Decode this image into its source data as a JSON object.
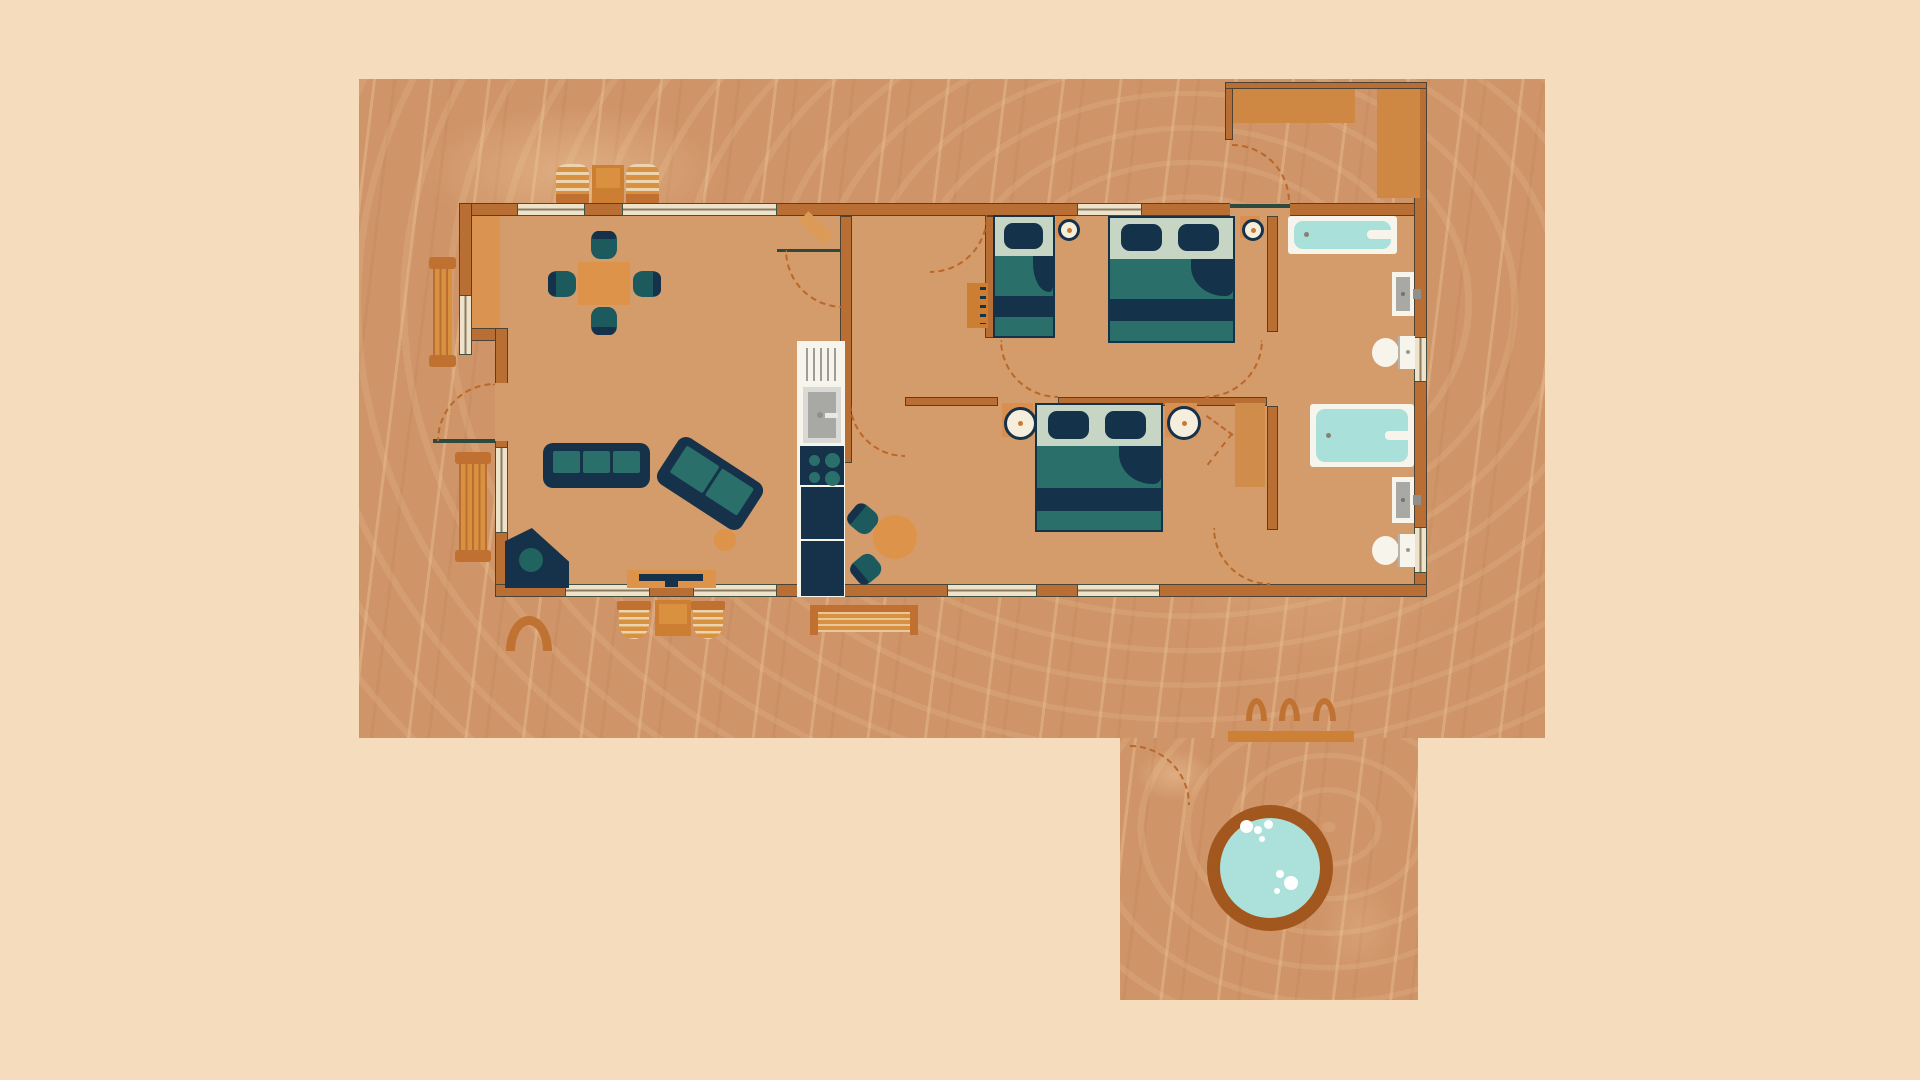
{
  "title": "Cabin floor plan illustration",
  "palette": {
    "background": "#f4dcbd",
    "deck": "#cf9468",
    "floor": "#d49c6b",
    "wall": "#b96f33",
    "wall_outline": "#4d4233",
    "accent_orange": "#dd9349",
    "accent_dark": "#c07030",
    "canopy": "#cf8843",
    "navy": "#16324a",
    "teal": "#1d5a5e",
    "teal_mid": "#2a6f6a",
    "sage": "#c7d5c5",
    "window_fill": "#efe2cb",
    "fixture_white": "#f7f4ec",
    "basin_gray": "#a8a8a4",
    "water": "#a9e0da",
    "hottub_rim": "#a2571e",
    "door_swing_dash": "#b9682a",
    "door_line": "#2e4a3e",
    "rug": "#da9350",
    "wardrobe": "#d08c4a"
  },
  "floorplan": {
    "canvas": {
      "width": 1920,
      "height": 1080
    },
    "elements": [
      {
        "type": "deck",
        "name": "deck-main",
        "x": 359,
        "y": 79,
        "w": 1186,
        "h": 659
      },
      {
        "type": "deck",
        "name": "deck-lower-hot-tub-area",
        "x": 1120,
        "y": 738,
        "w": 298,
        "h": 262
      },
      {
        "type": "lounger",
        "name": "deck-lounger-1",
        "x": 556,
        "y": 164,
        "w": 33,
        "h": 40
      },
      {
        "type": "rect",
        "name": "deck-lounger-table",
        "x": 592,
        "y": 165,
        "w": 32,
        "h": 39,
        "fill": "#cc7f33"
      },
      {
        "type": "rect",
        "name": "deck-lounger-table-top",
        "x": 596,
        "y": 168,
        "w": 24,
        "h": 20,
        "fill": "#d9903f"
      },
      {
        "type": "lounger",
        "name": "deck-lounger-2",
        "x": 626,
        "y": 164,
        "w": 33,
        "h": 40
      },
      {
        "type": "benchv",
        "name": "deck-bench-upper-left",
        "x": 429,
        "y": 257,
        "w": 27,
        "h": 110
      },
      {
        "type": "benchv",
        "name": "deck-bench-lower-left",
        "x": 455,
        "y": 452,
        "w": 36,
        "h": 110
      },
      {
        "type": "outchair",
        "name": "deck-chair-1",
        "x": 617,
        "y": 601,
        "w": 34,
        "h": 38
      },
      {
        "type": "rect",
        "name": "deck-table",
        "x": 655,
        "y": 600,
        "w": 36,
        "h": 36,
        "fill": "#cc7f33"
      },
      {
        "type": "rect",
        "name": "deck-table-top",
        "x": 659,
        "y": 604,
        "w": 28,
        "h": 20,
        "fill": "#d9903f"
      },
      {
        "type": "outchair",
        "name": "deck-chair-2",
        "x": 691,
        "y": 601,
        "w": 34,
        "h": 38
      },
      {
        "type": "benchlong",
        "name": "deck-bench-long",
        "x": 810,
        "y": 605,
        "w": 108,
        "h": 30
      },
      {
        "type": "arch",
        "name": "deck-arch-mat",
        "x": 506,
        "y": 616,
        "w": 46,
        "h": 35,
        "bw": 9
      },
      {
        "type": "arch",
        "name": "hot-tub-step-hoop-1",
        "x": 1246,
        "y": 698,
        "w": 21,
        "h": 23,
        "bw": 6
      },
      {
        "type": "arch",
        "name": "hot-tub-step-hoop-2",
        "x": 1279,
        "y": 698,
        "w": 21,
        "h": 23,
        "bw": 6
      },
      {
        "type": "arch",
        "name": "hot-tub-step-hoop-3",
        "x": 1313,
        "y": 698,
        "w": 23,
        "h": 23,
        "bw": 6
      },
      {
        "type": "rect",
        "name": "hot-tub-step-bar",
        "x": 1228,
        "y": 731,
        "w": 126,
        "h": 11,
        "fill": "#cc8136"
      },
      {
        "type": "arc",
        "name": "hot-tub-path-arc",
        "x": 1130,
        "y": 745,
        "w": 60,
        "h": 60,
        "corner": "tr"
      },
      {
        "type": "hottub",
        "name": "hot-tub",
        "x": 1207,
        "y": 805,
        "w": 126,
        "h": 126,
        "bubbles": [
          [
            33,
            15,
            13
          ],
          [
            47,
            21,
            8
          ],
          [
            57,
            15,
            9
          ],
          [
            52,
            31,
            6
          ],
          [
            77,
            71,
            14
          ],
          [
            69,
            65,
            8
          ],
          [
            67,
            83,
            6
          ]
        ]
      },
      {
        "type": "floor",
        "name": "house-floor",
        "x": 459,
        "y": 203,
        "w": 968,
        "h": 394
      },
      {
        "type": "rect",
        "name": "entry-rug",
        "x": 472,
        "y": 216,
        "w": 28,
        "h": 124,
        "fill": "#da9350"
      },
      {
        "type": "wall",
        "name": "wall-top",
        "x": 459,
        "y": 203,
        "w": 968,
        "h": 13
      },
      {
        "type": "wall",
        "name": "wall-left-upper",
        "x": 459,
        "y": 203,
        "w": 13,
        "h": 138
      },
      {
        "type": "wall",
        "name": "wall-left-step",
        "x": 459,
        "y": 328,
        "w": 49,
        "h": 13
      },
      {
        "type": "wall",
        "name": "wall-left-lower",
        "x": 495,
        "y": 328,
        "w": 13,
        "h": 269
      },
      {
        "type": "wall",
        "name": "wall-right",
        "x": 1414,
        "y": 82,
        "w": 13,
        "h": 515
      },
      {
        "type": "wall",
        "name": "wall-bottom",
        "x": 495,
        "y": 584,
        "w": 932,
        "h": 13
      },
      {
        "type": "wall",
        "name": "wall-kitchen-hall",
        "x": 840,
        "y": 216,
        "w": 12,
        "h": 247
      },
      {
        "type": "wall",
        "name": "wall-bedroom-divider-left",
        "x": 905,
        "y": 397,
        "w": 93,
        "h": 9
      },
      {
        "type": "wall",
        "name": "wall-bedroom-divider-right",
        "x": 1058,
        "y": 397,
        "w": 209,
        "h": 9
      },
      {
        "type": "wall",
        "name": "wall-bedroom1-left",
        "x": 985,
        "y": 216,
        "w": 9,
        "h": 122
      },
      {
        "type": "wall",
        "name": "wall-bath1-left",
        "x": 1267,
        "y": 216,
        "w": 11,
        "h": 116
      },
      {
        "type": "wall",
        "name": "wall-bath2-left",
        "x": 1267,
        "y": 406,
        "w": 11,
        "h": 124
      },
      {
        "type": "wall",
        "name": "porch-wall-left",
        "x": 1225,
        "y": 82,
        "w": 8,
        "h": 58
      },
      {
        "type": "wall",
        "name": "porch-wall-top",
        "x": 1225,
        "y": 82,
        "w": 202,
        "h": 7
      },
      {
        "type": "rect",
        "name": "porch-canopy-wide",
        "x": 1233,
        "y": 89,
        "w": 122,
        "h": 34,
        "fill": "#cf8843"
      },
      {
        "type": "rect",
        "name": "porch-canopy-tall",
        "x": 1377,
        "y": 89,
        "w": 43,
        "h": 109,
        "fill": "#cf8843"
      },
      {
        "type": "window",
        "name": "window-top-1",
        "x": 517,
        "y": 203,
        "w": 68,
        "h": 13,
        "dir": "h"
      },
      {
        "type": "window",
        "name": "window-top-2",
        "x": 622,
        "y": 203,
        "w": 155,
        "h": 13,
        "dir": "h"
      },
      {
        "type": "window",
        "name": "window-top-bedroom1",
        "x": 1077,
        "y": 203,
        "w": 65,
        "h": 13,
        "dir": "h"
      },
      {
        "type": "window",
        "name": "window-left-upper",
        "x": 459,
        "y": 295,
        "w": 13,
        "h": 60,
        "dir": "v"
      },
      {
        "type": "window",
        "name": "window-left-lower",
        "x": 495,
        "y": 447,
        "w": 13,
        "h": 86,
        "dir": "v"
      },
      {
        "type": "window",
        "name": "window-right-bath1",
        "x": 1414,
        "y": 337,
        "w": 13,
        "h": 45,
        "dir": "v"
      },
      {
        "type": "window",
        "name": "window-bottom-1",
        "x": 565,
        "y": 584,
        "w": 85,
        "h": 13,
        "dir": "h"
      },
      {
        "type": "window",
        "name": "window-bottom-2",
        "x": 693,
        "y": 584,
        "w": 84,
        "h": 13,
        "dir": "h"
      },
      {
        "type": "window",
        "name": "window-bottom-3",
        "x": 947,
        "y": 584,
        "w": 90,
        "h": 13,
        "dir": "h"
      },
      {
        "type": "window",
        "name": "window-bottom-4",
        "x": 1077,
        "y": 584,
        "w": 83,
        "h": 13,
        "dir": "h"
      },
      {
        "type": "window",
        "name": "window-right-bath2",
        "x": 1414,
        "y": 527,
        "w": 13,
        "h": 46,
        "dir": "v"
      },
      {
        "type": "gap",
        "name": "front-door-gap",
        "x": 495,
        "y": 383,
        "w": 13,
        "h": 58
      },
      {
        "type": "gap",
        "name": "porch-door-gap",
        "x": 1230,
        "y": 203,
        "w": 60,
        "h": 13
      },
      {
        "type": "doorline",
        "name": "front-door-leaf",
        "x": 433,
        "y": 439,
        "w": 62,
        "h": 4
      },
      {
        "type": "doorline",
        "name": "closet-door-line",
        "x": 777,
        "y": 249,
        "w": 64,
        "h": 3
      },
      {
        "type": "doorline",
        "name": "porch-door-line",
        "x": 1230,
        "y": 204,
        "w": 60,
        "h": 4
      },
      {
        "type": "rect",
        "name": "dining-table",
        "x": 578,
        "y": 262,
        "w": 52,
        "h": 43,
        "fill": "#dd9349"
      },
      {
        "type": "chair",
        "name": "dining-chair-north",
        "x": 591,
        "y": 231,
        "w": 26,
        "h": 28,
        "rot": 0
      },
      {
        "type": "chair",
        "name": "dining-chair-south",
        "x": 591,
        "y": 307,
        "w": 26,
        "h": 28,
        "rot": 180
      },
      {
        "type": "chair",
        "name": "dining-chair-west",
        "x": 549,
        "y": 270,
        "w": 26,
        "h": 28,
        "rot": -90
      },
      {
        "type": "chair",
        "name": "dining-chair-east",
        "x": 634,
        "y": 270,
        "w": 26,
        "h": 28,
        "rot": 90
      },
      {
        "type": "sofa",
        "name": "sofa-three-seat",
        "x": 543,
        "y": 443,
        "w": 107,
        "h": 45,
        "cushions": 3,
        "rot": 0
      },
      {
        "type": "sofa",
        "name": "sofa-two-seat",
        "x": 660,
        "y": 456,
        "w": 100,
        "h": 55,
        "cushions": 2,
        "rot": 33
      },
      {
        "type": "circle",
        "name": "side-table",
        "x": 714,
        "y": 529,
        "d": 22,
        "fill": "#dd9349"
      },
      {
        "type": "cornerstove",
        "name": "corner-stove",
        "x": 505,
        "y": 528,
        "w": 64,
        "h": 60
      },
      {
        "type": "tvunit",
        "name": "tv-console",
        "x": 627,
        "y": 570,
        "w": 89,
        "h": 18
      },
      {
        "type": "rect",
        "name": "kitchen-column",
        "x": 797,
        "y": 341,
        "w": 48,
        "h": 256,
        "fill": "#f7f4ec"
      },
      {
        "type": "fridge",
        "name": "fridge",
        "x": 804,
        "y": 346,
        "w": 34,
        "h": 37
      },
      {
        "type": "sinkk",
        "name": "kitchen-sink",
        "x": 803,
        "y": 387,
        "w": 38,
        "h": 56
      },
      {
        "type": "stovek",
        "name": "kitchen-stove",
        "x": 800,
        "y": 446,
        "w": 44,
        "h": 39
      },
      {
        "type": "rect",
        "name": "kitchen-counter-1",
        "x": 801,
        "y": 487,
        "w": 43,
        "h": 52,
        "fill": "#16324a"
      },
      {
        "type": "rect",
        "name": "kitchen-counter-2",
        "x": 801,
        "y": 541,
        "w": 43,
        "h": 55,
        "fill": "#16324a"
      },
      {
        "type": "circle",
        "name": "breakfast-table",
        "x": 873,
        "y": 515,
        "d": 44,
        "fill": "#dd9349"
      },
      {
        "type": "chair",
        "name": "breakfast-chair-upper",
        "x": 850,
        "y": 505,
        "w": 26,
        "h": 28,
        "rot": -50
      },
      {
        "type": "chair",
        "name": "breakfast-chair-lower",
        "x": 853,
        "y": 555,
        "w": 26,
        "h": 28,
        "rot": -130
      },
      {
        "type": "rect",
        "name": "closet-door-leaf-open",
        "x": 799,
        "y": 221,
        "w": 34,
        "h": 14,
        "fill": "#dc9a58",
        "rot": 43
      },
      {
        "type": "dresser",
        "name": "hall-dresser",
        "x": 967,
        "y": 283,
        "w": 21,
        "h": 45
      },
      {
        "type": "bed",
        "name": "bed-twin-bedroom1",
        "x": 993,
        "y": 215,
        "w": 62,
        "h": 123,
        "pillows": 1
      },
      {
        "type": "bed",
        "name": "bed-double-bedroom1",
        "x": 1108,
        "y": 216,
        "w": 127,
        "h": 127,
        "pillows": 2
      },
      {
        "type": "bed",
        "name": "bed-double-bedroom2",
        "x": 1035,
        "y": 403,
        "w": 128,
        "h": 129,
        "pillows": 2
      },
      {
        "type": "lamp",
        "name": "wall-lamp-bedroom1-left",
        "x": 1056,
        "y": 216,
        "w": 20,
        "h": 22
      },
      {
        "type": "lamp",
        "name": "wall-lamp-bedroom1-right",
        "x": 1240,
        "y": 216,
        "w": 20,
        "h": 22
      },
      {
        "type": "lamp",
        "name": "nightstand-bedroom2-left",
        "x": 1002,
        "y": 403,
        "w": 31,
        "h": 34
      },
      {
        "type": "lamp",
        "name": "nightstand-bedroom2-right",
        "x": 1165,
        "y": 403,
        "w": 32,
        "h": 34
      },
      {
        "type": "rect",
        "name": "wardrobe-bedroom2",
        "x": 1235,
        "y": 403,
        "w": 30,
        "h": 84,
        "fill": "#d08c4a"
      },
      {
        "type": "dashline",
        "name": "bifold-closet-mark-1",
        "x": 1207,
        "y": 415,
        "len": 33,
        "rot": 36
      },
      {
        "type": "dashline",
        "name": "bifold-closet-mark-2",
        "x": 1233,
        "y": 434,
        "len": 40,
        "rot": 128
      },
      {
        "type": "tub",
        "name": "bathtub-bathroom1",
        "x": 1288,
        "y": 216,
        "w": 109,
        "h": 38
      },
      {
        "type": "sinkb",
        "name": "sink-bathroom1",
        "x": 1392,
        "y": 272,
        "w": 22,
        "h": 44
      },
      {
        "type": "toilet",
        "name": "toilet-bathroom1",
        "x": 1372,
        "y": 336,
        "w": 43,
        "h": 33
      },
      {
        "type": "tub",
        "name": "bathtub-bathroom2",
        "x": 1310,
        "y": 404,
        "w": 104,
        "h": 63
      },
      {
        "type": "sinkb",
        "name": "sink-bathroom2",
        "x": 1392,
        "y": 477,
        "w": 22,
        "h": 46
      },
      {
        "type": "toilet",
        "name": "toilet-bathroom2",
        "x": 1372,
        "y": 534,
        "w": 43,
        "h": 33
      },
      {
        "type": "arc",
        "name": "front-door-swing",
        "x": 437,
        "y": 383,
        "w": 58,
        "h": 58,
        "corner": "tl"
      },
      {
        "type": "arc",
        "name": "closet-door-swing",
        "x": 785,
        "y": 250,
        "w": 58,
        "h": 58,
        "corner": "bl"
      },
      {
        "type": "arc",
        "name": "nook-door-swing",
        "x": 849,
        "y": 401,
        "w": 56,
        "h": 56,
        "corner": "bl"
      },
      {
        "type": "arc",
        "name": "hall-door-swing",
        "x": 930,
        "y": 215,
        "w": 58,
        "h": 58,
        "corner": "br"
      },
      {
        "type": "arc",
        "name": "bedroom1-door-swing",
        "x": 1000,
        "y": 340,
        "w": 58,
        "h": 58,
        "corner": "bl"
      },
      {
        "type": "arc",
        "name": "bathroom1-door-swing",
        "x": 1205,
        "y": 340,
        "w": 58,
        "h": 58,
        "corner": "br"
      },
      {
        "type": "arc",
        "name": "bedroom2-door-swing",
        "x": 1213,
        "y": 528,
        "w": 57,
        "h": 57,
        "corner": "bl"
      },
      {
        "type": "arc",
        "name": "porch-door-swing",
        "x": 1232,
        "y": 144,
        "w": 58,
        "h": 58,
        "corner": "tr"
      },
      {
        "type": "region",
        "name": "living-dining-room-region",
        "x": 472,
        "y": 216,
        "w": 368,
        "h": 368
      },
      {
        "type": "region",
        "name": "kitchen-region",
        "x": 797,
        "y": 341,
        "w": 48,
        "h": 256
      },
      {
        "type": "region",
        "name": "hallway-region",
        "x": 852,
        "y": 216,
        "w": 133,
        "h": 181
      },
      {
        "type": "region",
        "name": "bedroom1-region",
        "x": 995,
        "y": 216,
        "w": 272,
        "h": 181
      },
      {
        "type": "region",
        "name": "bedroom2-region",
        "x": 852,
        "y": 406,
        "w": 415,
        "h": 178
      },
      {
        "type": "region",
        "name": "bathroom1-region",
        "x": 1278,
        "y": 216,
        "w": 136,
        "h": 181
      },
      {
        "type": "region",
        "name": "bathroom2-region",
        "x": 1278,
        "y": 406,
        "w": 136,
        "h": 178
      },
      {
        "type": "region",
        "name": "porch-entry-region",
        "x": 1233,
        "y": 89,
        "w": 181,
        "h": 114
      }
    ]
  }
}
